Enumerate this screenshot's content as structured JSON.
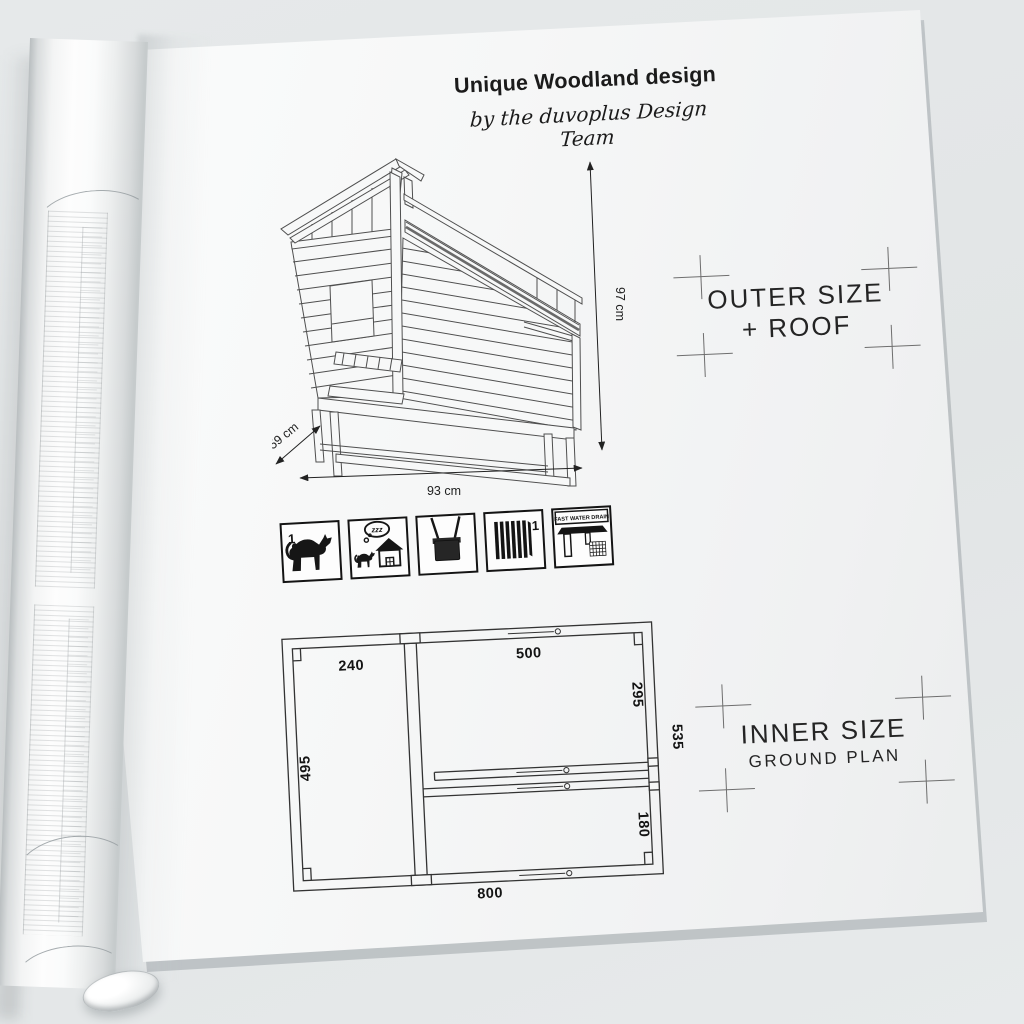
{
  "page": {
    "background": "#e3e6e7",
    "paper": "#f6f7f7",
    "ink": "#1b1b1b",
    "line_color": "#4f4f4f"
  },
  "header": {
    "title": "Unique Woodland design",
    "subtitle": "by the duvoplus Design Team"
  },
  "outer_drawing": {
    "caption_line1": "OUTER SIZE",
    "caption_line2": "+ ROOF",
    "height_label": "97 cm",
    "depth_label": "59 cm",
    "width_label": "93 cm"
  },
  "feature_icons": [
    {
      "name": "capacity-one-cat",
      "badge": "1"
    },
    {
      "name": "sleeping-house",
      "bubble": "zzz"
    },
    {
      "name": "hanging-cabin"
    },
    {
      "name": "lockable-door",
      "badge": "1"
    },
    {
      "name": "fast-water-drain",
      "label": "FAST WATER DRAIN"
    }
  ],
  "ground_plan": {
    "caption_line1": "INNER SIZE",
    "caption_line2": "GROUND PLAN",
    "dim_top_left": "240",
    "dim_top_right": "500",
    "dim_right_upper": "295",
    "dim_right_total": "535",
    "dim_left": "495",
    "dim_right_lower": "180",
    "dim_bottom": "800"
  }
}
